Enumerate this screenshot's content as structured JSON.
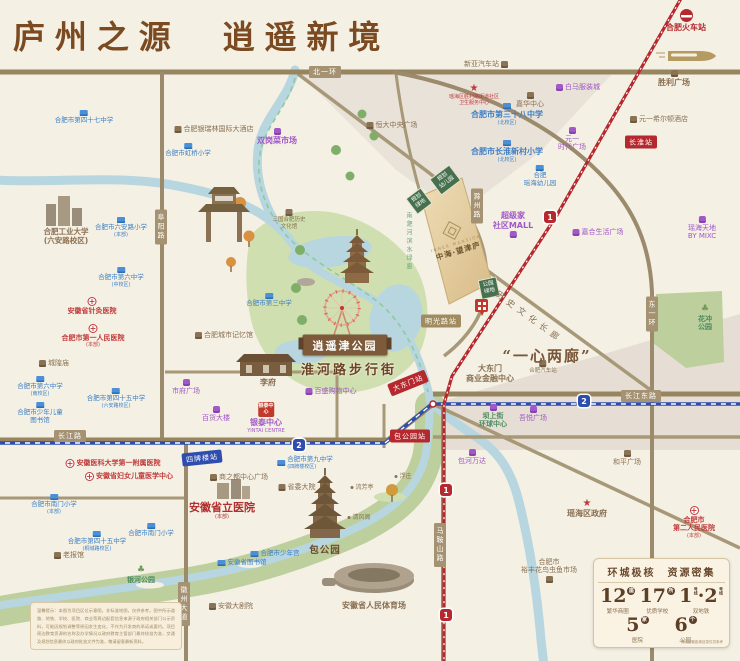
{
  "title": "庐州之源　逍遥新境",
  "features": {
    "park_ribbon": "逍遥津公园",
    "huaihe_street": "淮河路步行街",
    "one_heart": "“一心两廊”",
    "corridor": "历史文化长廊",
    "river_corridor": "南淝河滨水绿廊"
  },
  "project": {
    "en": "INNER MANSION",
    "cn": "中海·望津庐"
  },
  "stats": {
    "title": "环城极核　资源密集",
    "row1": [
      {
        "num": "12",
        "unit": "座",
        "label": "繁华商圈"
      },
      {
        "num": "17",
        "unit": "所",
        "label": "优质学校"
      }
    ],
    "metro": {
      "n1": "1",
      "sep": "·",
      "n2": "2",
      "unit": "号线",
      "label": "双地铁"
    },
    "row2": [
      {
        "num": "5",
        "unit": "家",
        "label": "医院"
      },
      {
        "num": "6",
        "unit": "个",
        "label": "公园"
      }
    ],
    "note": "*周边配套距离信息仅供参考"
  },
  "disclaimer": "温馨提示：本图为项目区位示意图，非标准地图，仅供参考。图中所示道路、地铁、学校、医院、商业等周边配套信息来源于政府相关部门公示资料，可能因规划调整等原因发生变化，不作为开发商的承诺或要约。项目周边教育资源的名称及办学情况以政府教育主管部门最终核准为准，交通及规划信息最终以政府批准文件为准，敬请留意最新资料。",
  "map": {
    "road_labels": [
      {
        "text": "北一环",
        "x": 325,
        "y": 72
      },
      {
        "text": "长江路",
        "x": 70,
        "y": 436
      },
      {
        "text": "长江东路",
        "x": 641,
        "y": 396
      },
      {
        "text": "阜阳路",
        "x": 161,
        "y": 227,
        "v": 1
      },
      {
        "text": "徽州大道",
        "x": 184,
        "y": 604,
        "v": 1
      },
      {
        "text": "东一环",
        "x": 652,
        "y": 314,
        "v": 1
      },
      {
        "text": "马鞍山路",
        "x": 440,
        "y": 545,
        "v": 1
      },
      {
        "text": "滁州路",
        "x": 477,
        "y": 206,
        "v": 1
      }
    ],
    "stations": [
      {
        "l": "1",
        "text": "长淮站",
        "x": 641,
        "y": 142
      },
      {
        "l": "1",
        "text": "大东门站",
        "x": 408,
        "y": 383,
        "r": -22
      },
      {
        "l": "1",
        "text": "包公园站",
        "x": 410,
        "y": 436
      },
      {
        "l": "2",
        "text": "四牌楼站",
        "x": 202,
        "y": 458,
        "r": -6
      },
      {
        "l": "t",
        "text": "明光路站",
        "x": 441,
        "y": 321
      }
    ],
    "badges": [
      {
        "l": "2",
        "x": 299,
        "y": 445
      },
      {
        "l": "2",
        "x": 584,
        "y": 401
      },
      {
        "l": "1",
        "x": 550,
        "y": 217
      },
      {
        "l": "1",
        "x": 446,
        "y": 490
      },
      {
        "l": "1",
        "x": 446,
        "y": 615
      }
    ],
    "green_boxes": [
      {
        "lines": [
          "规划",
          "幼儿园"
        ],
        "x": 445,
        "y": 180,
        "r": -37
      },
      {
        "lines": [
          "规划",
          "绿地"
        ],
        "x": 419,
        "y": 201,
        "r": -37
      },
      {
        "lines": [
          "公园",
          "绿地"
        ],
        "x": 489,
        "y": 288,
        "r": -12
      }
    ],
    "pois": [
      {
        "t": "sch",
        "ic": "sch",
        "ip": "t",
        "x": 84,
        "y": 110,
        "ls": [
          "合肥市第四十七中学"
        ]
      },
      {
        "t": "sch",
        "ic": "sch",
        "ip": "t",
        "x": 188,
        "y": 143,
        "ls": [
          "合肥市虹桥小学"
        ]
      },
      {
        "t": "sch",
        "ic": "sch",
        "ip": "t",
        "x": 507,
        "y": 103,
        "ls": [
          "合肥市第三十八中学"
        ],
        "sub": "(北校区)",
        "cls": "lg"
      },
      {
        "t": "sch",
        "ic": "sch",
        "ip": "t",
        "x": 507,
        "y": 140,
        "ls": [
          "合肥市长淮新村小学"
        ],
        "sub": "(北校区)",
        "cls": "lg"
      },
      {
        "t": "sch",
        "ic": "sch",
        "ip": "t",
        "x": 540,
        "y": 165,
        "ls": [
          "合肥",
          "瑶海幼儿园"
        ]
      },
      {
        "t": "sch",
        "ic": "sch",
        "ip": "t",
        "x": 269,
        "y": 293,
        "ls": [
          "合肥市第三中学"
        ]
      },
      {
        "t": "sch",
        "ic": "sch",
        "ip": "t",
        "x": 121,
        "y": 217,
        "ls": [
          "合肥市六安路小学"
        ],
        "sub": "(本部)"
      },
      {
        "t": "sch",
        "ic": "sch",
        "ip": "t",
        "x": 121,
        "y": 267,
        "ls": [
          "合肥市第六中学"
        ],
        "sub": "(中校区)"
      },
      {
        "t": "sch",
        "ic": "sch",
        "ip": "t",
        "x": 40,
        "y": 376,
        "ls": [
          "合肥市第六中学"
        ],
        "sub": "(南校区)"
      },
      {
        "t": "sch",
        "ic": "sch",
        "ip": "t",
        "x": 116,
        "y": 388,
        "ls": [
          "合肥市第四十五中学"
        ],
        "sub": "(六安路校区)"
      },
      {
        "t": "sch",
        "ic": "sch",
        "ip": "t",
        "x": 40,
        "y": 402,
        "ls": [
          "合肥市少年儿童",
          "图书馆"
        ]
      },
      {
        "t": "sch",
        "ic": "sch",
        "ip": "t",
        "x": 54,
        "y": 494,
        "ls": [
          "合肥市南门小学"
        ],
        "sub": "(本部)"
      },
      {
        "t": "sch",
        "ic": "sch",
        "ip": "t",
        "x": 151,
        "y": 523,
        "ls": [
          "合肥市南门小学"
        ]
      },
      {
        "t": "sch",
        "ic": "sch",
        "ip": "t",
        "x": 97,
        "y": 531,
        "ls": [
          "合肥市第四十五中学"
        ],
        "sub": "(桐城路校区)"
      },
      {
        "t": "sch",
        "ic": "sch",
        "ip": "l",
        "x": 305,
        "y": 456,
        "ls": [
          "合肥市第九中学"
        ],
        "sub": "(四牌楼校区)"
      },
      {
        "t": "sch",
        "ic": "sch",
        "ip": "l",
        "x": 275,
        "y": 550,
        "ls": [
          "合肥市少年宫"
        ]
      },
      {
        "t": "sch",
        "ic": "sch",
        "ip": "l",
        "x": 242,
        "y": 559,
        "ls": [
          "安徽省图书馆"
        ]
      },
      {
        "t": "hos",
        "ic": "hos",
        "ip": "t",
        "x": 92,
        "y": 297,
        "ls": [
          "安徽省针灸医院"
        ]
      },
      {
        "t": "hos",
        "ic": "hos",
        "ip": "t",
        "x": 93,
        "y": 324,
        "ls": [
          "合肥市第一人民医院"
        ],
        "sub": "(本部)"
      },
      {
        "t": "hos",
        "ic": "hos",
        "ip": "l",
        "x": 113,
        "y": 459,
        "ls": [
          "安徽医科大学第一附属医院"
        ]
      },
      {
        "t": "hos",
        "ic": "hos",
        "ip": "l",
        "x": 129,
        "y": 472,
        "ls": [
          "安徽省妇女儿童医学中心"
        ]
      },
      {
        "t": "hos",
        "ic": "hos",
        "ip": "t",
        "x": 694,
        "y": 506,
        "ls": [
          "合肥市",
          "第二人民医院"
        ],
        "sub": "(本部)"
      },
      {
        "t": "hb",
        "x": 222,
        "y": 501,
        "ls": [
          "安徽省立医院"
        ],
        "sub": "(本部)"
      },
      {
        "t": "mal",
        "ic": "mal",
        "ip": "t",
        "x": 277,
        "y": 128,
        "ls": [
          "双岗菜市场"
        ],
        "cls": "lg"
      },
      {
        "t": "mal",
        "ic": "mal",
        "ip": "l",
        "x": 578,
        "y": 83,
        "ls": [
          "白马服装城"
        ]
      },
      {
        "t": "mal",
        "ic": "mal",
        "ip": "t",
        "x": 572,
        "y": 127,
        "ls": [
          "元一",
          "时代广场"
        ]
      },
      {
        "t": "mal",
        "ic": "mal",
        "ip": "b",
        "x": 513,
        "y": 211,
        "ls": [
          "超级家",
          "社区MALL"
        ],
        "cls": "lg"
      },
      {
        "t": "mal",
        "ic": "mal",
        "ip": "l",
        "x": 598,
        "y": 228,
        "ls": [
          "嘉合生活广场"
        ]
      },
      {
        "t": "mal",
        "ic": "mal",
        "ip": "t",
        "x": 702,
        "y": 216,
        "ls": [
          "瑶海天地",
          "BY MIXC"
        ]
      },
      {
        "t": "mal",
        "ic": "mal",
        "ip": "l",
        "x": 331,
        "y": 387,
        "ls": [
          "百盛购物中心"
        ]
      },
      {
        "t": "mal",
        "ic": "mal",
        "ip": "t",
        "x": 186,
        "y": 379,
        "ls": [
          "市府广场"
        ]
      },
      {
        "t": "mal",
        "ic": "mal",
        "ip": "t",
        "x": 216,
        "y": 406,
        "ls": [
          "百货大楼"
        ]
      },
      {
        "t": "mal",
        "ic": "mal",
        "ip": "t",
        "x": 533,
        "y": 406,
        "ls": [
          "吾悦广场"
        ]
      },
      {
        "t": "mal",
        "ic": "mal",
        "ip": "t",
        "x": 472,
        "y": 449,
        "ls": [
          "包河万达"
        ]
      },
      {
        "t": "mal",
        "ic": "yin",
        "ip": "t",
        "x": 266,
        "y": 402,
        "ls": [
          "银泰中心"
        ],
        "sub": "YINTAI CENTRE",
        "cls": "lg",
        "icon_text": "银泰中心"
      },
      {
        "t": "lan",
        "ic": "lan",
        "ip": "l",
        "x": 214,
        "y": 125,
        "ls": [
          "合肥银瑞林国际大酒店"
        ]
      },
      {
        "t": "lan",
        "ic": "lan",
        "ip": "l",
        "x": 392,
        "y": 121,
        "ls": [
          "恒大中央广场"
        ]
      },
      {
        "t": "lan",
        "ic": "lan",
        "ip": "r",
        "x": 486,
        "y": 60,
        "ls": [
          "新亚汽车站"
        ]
      },
      {
        "t": "lan",
        "ic": "lan",
        "ip": "t",
        "x": 530,
        "y": 92,
        "ls": [
          "嘉华中心"
        ]
      },
      {
        "t": "lan",
        "ic": "lan",
        "ip": "l",
        "x": 659,
        "y": 115,
        "ls": [
          "元一希尔顿酒店"
        ]
      },
      {
        "t": "lan",
        "ic": "lan",
        "ip": "t",
        "x": 674,
        "y": 70,
        "ls": [
          "胜利广场"
        ],
        "cls": "lg"
      },
      {
        "t": "lan",
        "ic": "lan",
        "ip": "t",
        "x": 289,
        "y": 209,
        "ls": [
          "三国合肥历史",
          "文化馆"
        ],
        "cls": "vsm2"
      },
      {
        "t": "lan",
        "ic": "lan",
        "ip": "l",
        "x": 224,
        "y": 331,
        "ls": [
          "合肥城市记忆馆"
        ]
      },
      {
        "t": "lan",
        "ic": "lan",
        "ip": "l",
        "x": 54,
        "y": 359,
        "ls": [
          "城隍庙"
        ]
      },
      {
        "t": "lan",
        "ic": "lan",
        "ip": "l",
        "x": 239,
        "y": 473,
        "ls": [
          "商之都中心广场"
        ]
      },
      {
        "t": "lan",
        "ic": "lan",
        "ip": "l",
        "x": 297,
        "y": 483,
        "ls": [
          "省委大院"
        ]
      },
      {
        "t": "lan",
        "ic": "lan",
        "ip": "l",
        "x": 69,
        "y": 551,
        "ls": [
          "老报馆"
        ]
      },
      {
        "t": "lan",
        "ic": "lan",
        "ip": "l",
        "x": 231,
        "y": 602,
        "ls": [
          "安徽大剧院"
        ]
      },
      {
        "t": "lan",
        "ic": "lan",
        "ip": "t",
        "x": 543,
        "y": 360,
        "ls": [
          "合肥汽车站"
        ],
        "cls": "vsm2"
      },
      {
        "t": "lan",
        "x": 490,
        "y": 364,
        "ls": [
          "大东门",
          "商业金融中心"
        ],
        "cls": "lg"
      },
      {
        "t": "lan",
        "ic": "lan",
        "ip": "t",
        "x": 627,
        "y": 450,
        "ls": [
          "和平广场"
        ]
      },
      {
        "t": "lan",
        "ic": "lan",
        "ip": "b",
        "x": 549,
        "y": 558,
        "ls": [
          "合肥市",
          "裕丰花鸟虫鱼市场"
        ]
      },
      {
        "t": "lan",
        "x": 374,
        "y": 601,
        "ls": [
          "安徽省人民体育场"
        ],
        "cls": "lg"
      },
      {
        "t": "lan",
        "x": 268,
        "y": 378,
        "ls": [
          "李府"
        ],
        "cls": "lg"
      },
      {
        "t": "uni",
        "x": 66,
        "y": 227,
        "ls": [
          "合肥工业大学",
          "(六安路校区)"
        ]
      },
      {
        "t": "hos",
        "ic": "star",
        "ip": "t",
        "x": 474,
        "y": 84,
        "ls": [
          "瑶海区胜利路街道社区",
          "卫生服务中心"
        ],
        "cls": "vsm"
      },
      {
        "t": "lan",
        "ic": "star",
        "ip": "t",
        "x": 587,
        "y": 499,
        "ls": [
          "瑶海区政府"
        ],
        "cls": "lg"
      },
      {
        "t": "grn",
        "ic": "tree",
        "ip": "t",
        "x": 705,
        "y": 305,
        "ls": [
          "花冲",
          "公园"
        ]
      },
      {
        "t": "grn",
        "ic": "tree",
        "ip": "t",
        "x": 141,
        "y": 566,
        "ls": [
          "银河公园"
        ]
      },
      {
        "t": "grn",
        "ic": "mal",
        "ip": "t",
        "x": 493,
        "y": 404,
        "ls": [
          "坝上街",
          "环球中心"
        ]
      },
      {
        "t": "big",
        "x": 325,
        "y": 545,
        "ls": [
          "包公园"
        ]
      },
      {
        "t": "tin",
        "ic": "dot",
        "ip": "l",
        "x": 403,
        "y": 473,
        "ls": [
          "浮庄"
        ]
      },
      {
        "t": "tin",
        "ic": "dot",
        "ip": "l",
        "x": 362,
        "y": 484,
        "ls": [
          "流芳亭"
        ]
      },
      {
        "t": "tin",
        "ic": "dot",
        "ip": "l",
        "x": 359,
        "y": 514,
        "ls": [
          "清风阁"
        ]
      },
      {
        "t": "trn",
        "ic": "rail",
        "ip": "t",
        "x": 686,
        "y": 9,
        "ls": [
          "合肥火车站"
        ]
      }
    ]
  }
}
